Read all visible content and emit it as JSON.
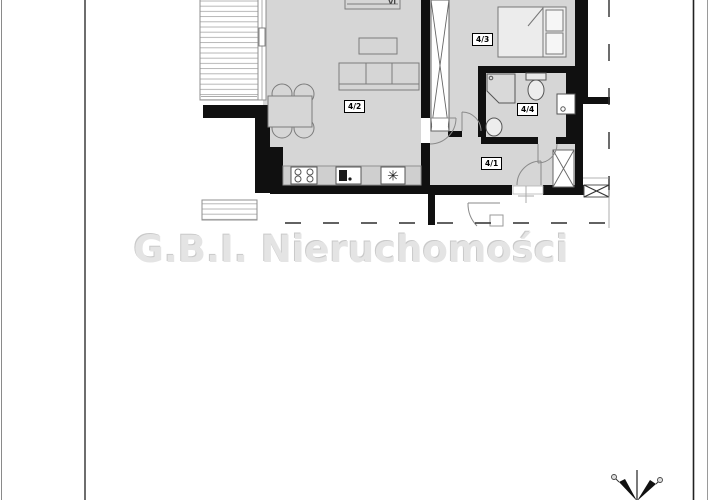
{
  "watermark": {
    "text": "G.B.I. Nieruchomości"
  },
  "plan": {
    "room_labels": [
      {
        "id": "4-1",
        "label": "4/1"
      },
      {
        "id": "4-2",
        "label": "4/2"
      },
      {
        "id": "4-3",
        "label": "4/3"
      },
      {
        "id": "4-4",
        "label": "4/4"
      }
    ],
    "tv_cabinet_label": "VI",
    "fridge_symbol": "✳"
  },
  "colors": {
    "wall": "#101010",
    "floor": "#d6d6d6",
    "furniture_line": "#7c7c7c",
    "watermark_gray": "#e4e4e4"
  }
}
